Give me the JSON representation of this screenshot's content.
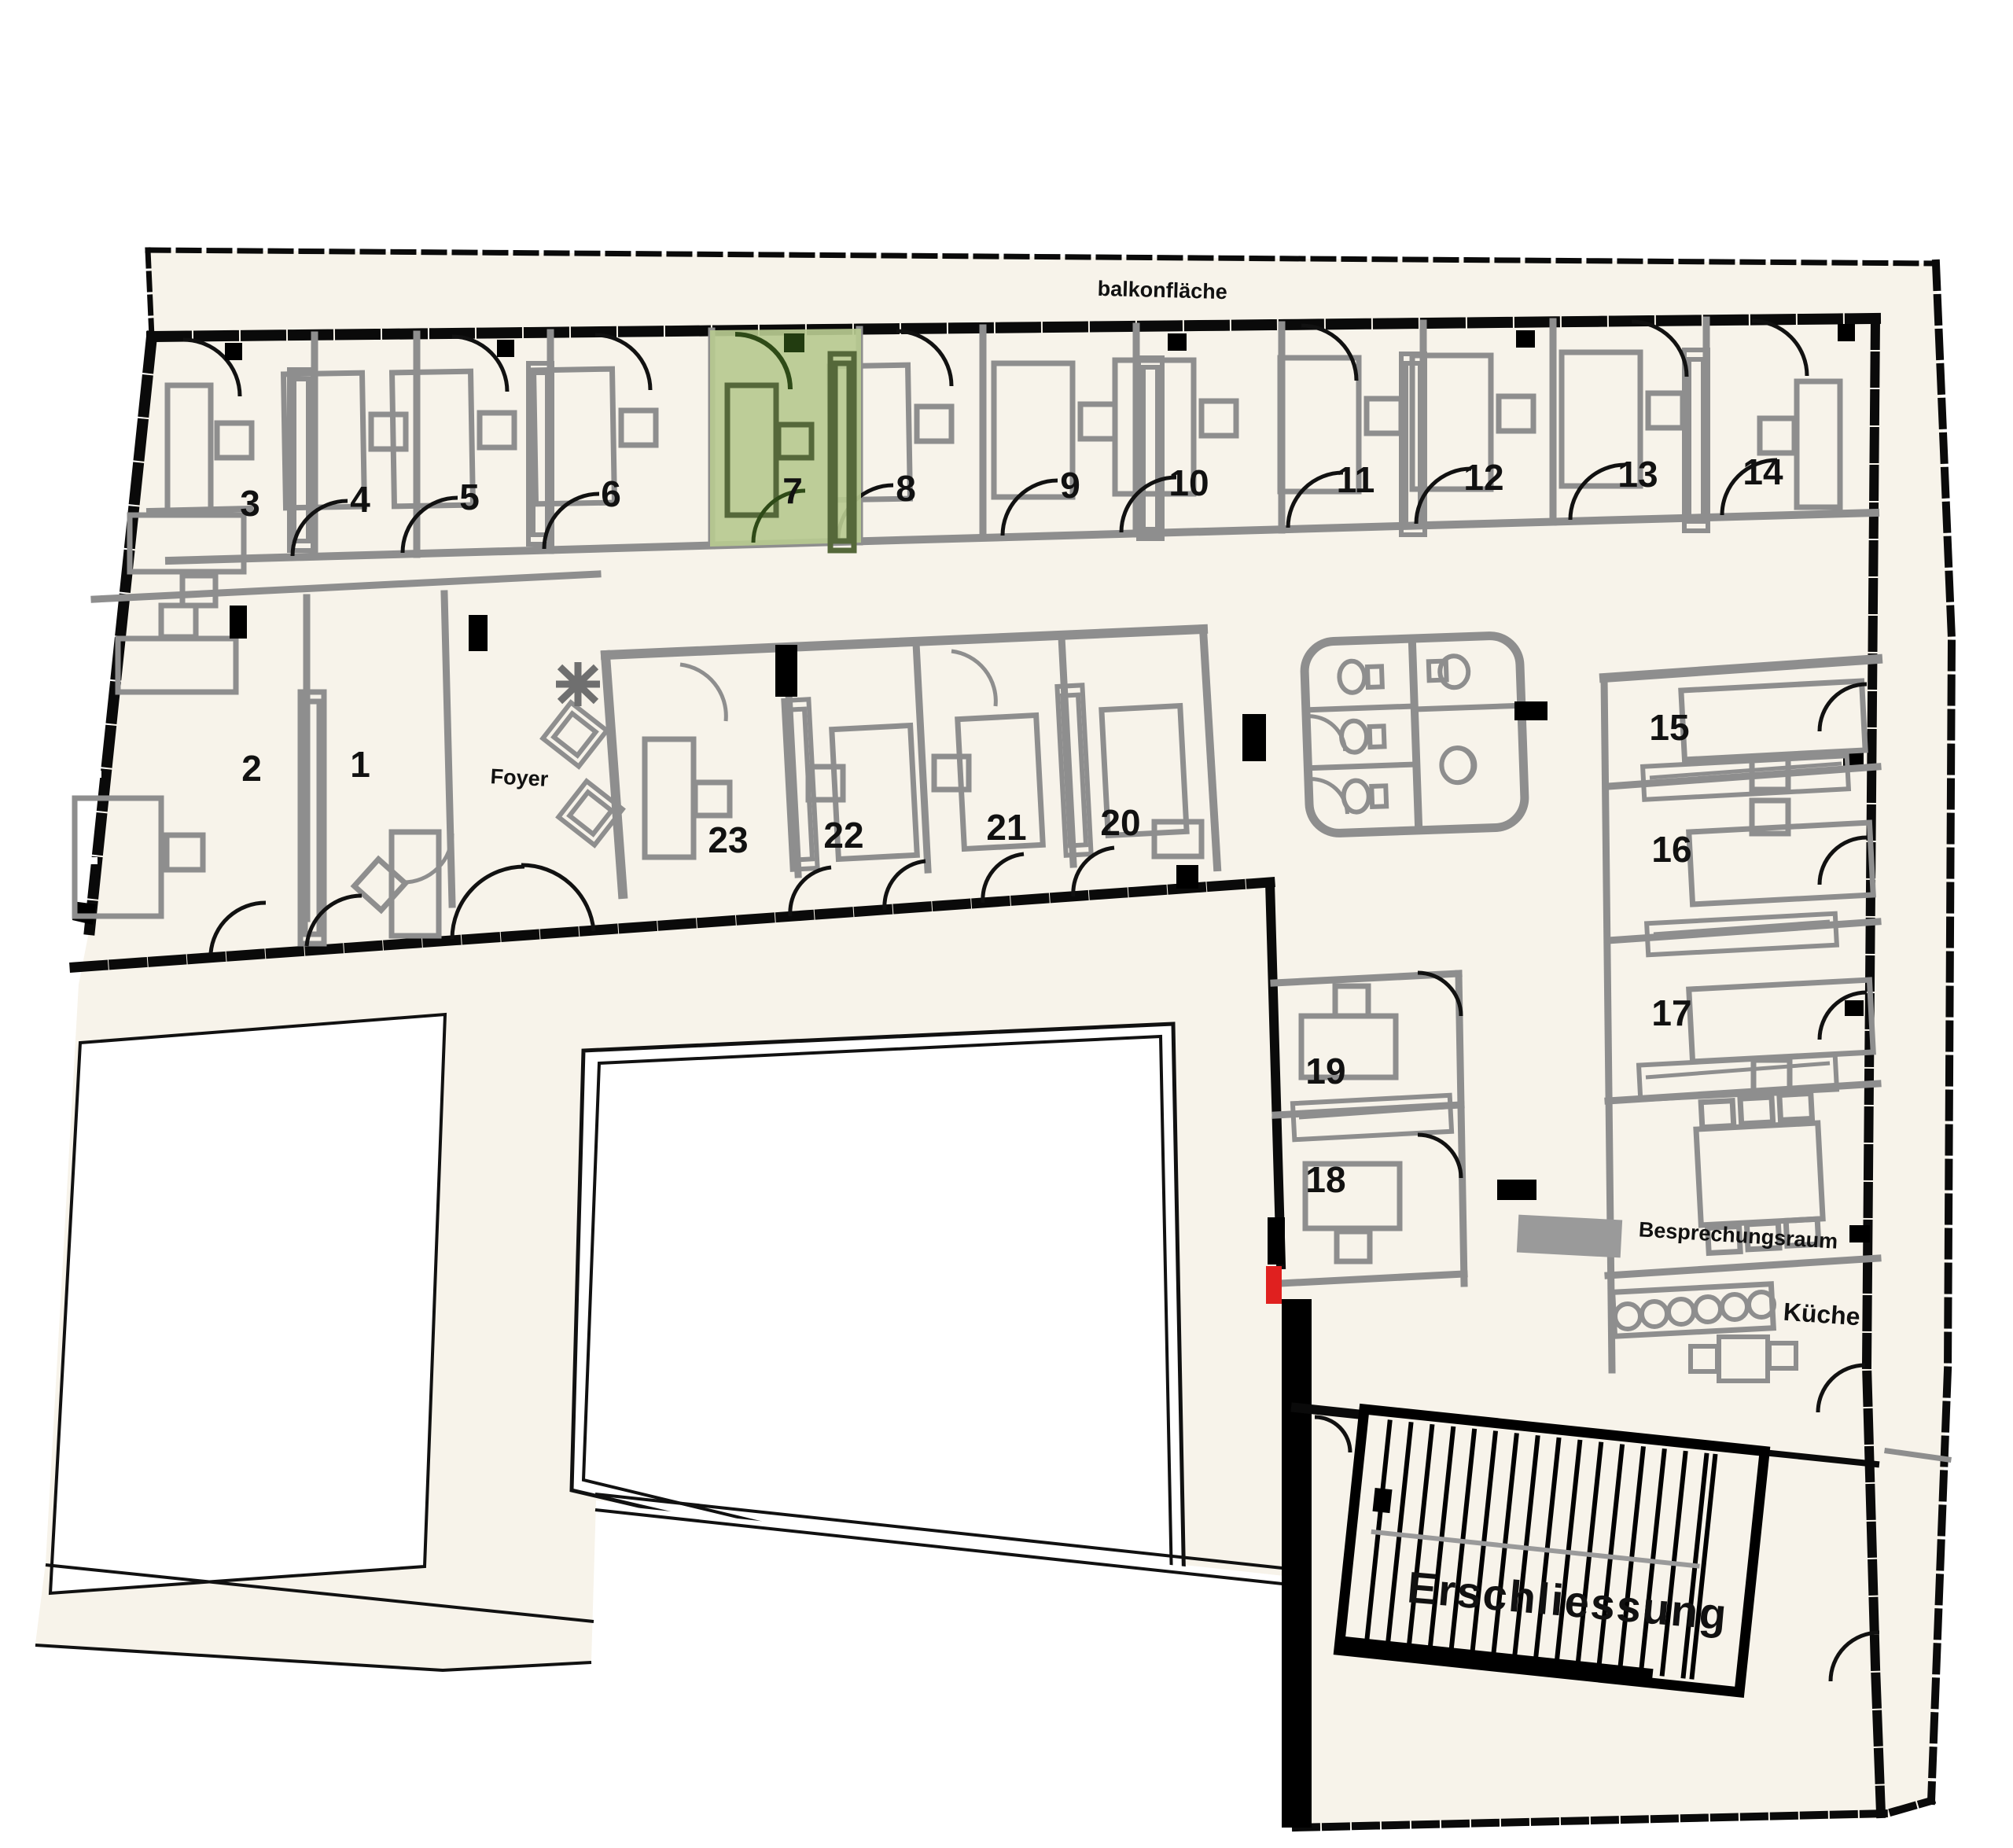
{
  "plan": {
    "region_labels": {
      "balcony": "balkonfläche",
      "foyer": "Foyer",
      "circulation": "Erschliessung",
      "meeting_room": "Besprechungsraum",
      "kitchen": "Küche"
    },
    "rooms": {
      "r1": "1",
      "r2": "2",
      "r3": "3",
      "r4": "4",
      "r5": "5",
      "r6": "6",
      "r7": "7",
      "r8": "8",
      "r9": "9",
      "r10": "10",
      "r11": "11",
      "r12": "12",
      "r13": "13",
      "r14": "14",
      "r15": "15",
      "r16": "16",
      "r17": "17",
      "r18": "18",
      "r19": "19",
      "r20": "20",
      "r21": "21",
      "r22": "22",
      "r23": "23"
    },
    "highlighted_room": {
      "number": "7",
      "fill": "#b7ca90"
    },
    "colors": {
      "paper": "#f7f3ea",
      "outside": "#ffffff",
      "walls": "#0a0a0a",
      "furniture": "#8e8e8e",
      "highlight": "#b7ca90",
      "highlight_dark": "#2e4a17",
      "exit_marker": "#e0201f"
    }
  }
}
